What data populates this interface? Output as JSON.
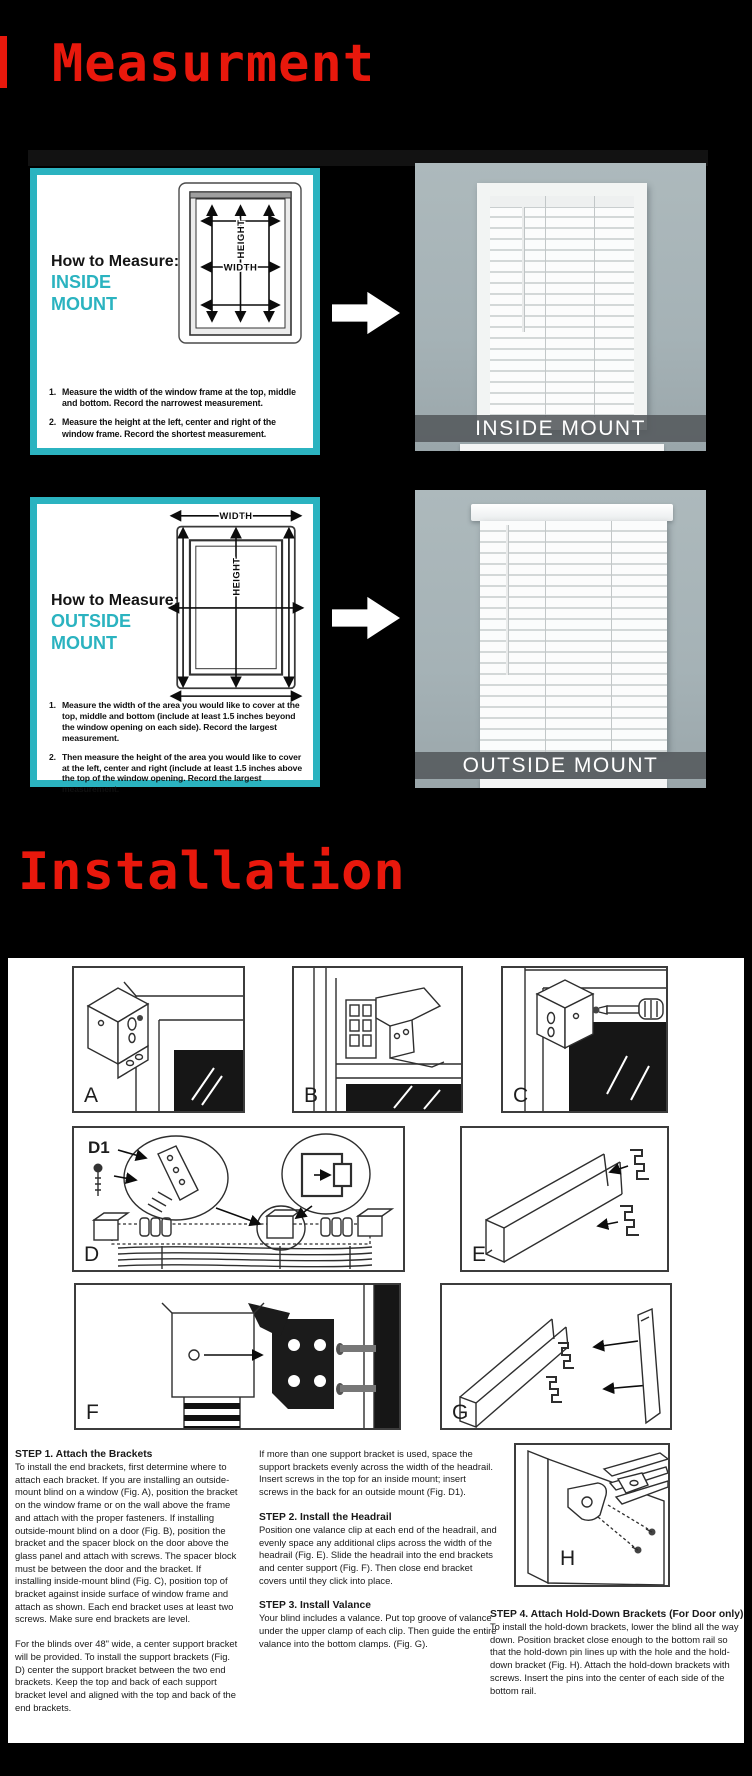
{
  "colors": {
    "accent_teal": "#2bb3c0",
    "title_red": "#e8180c",
    "photo_wall": "#a8b4b8",
    "caption_bar_gray": "#54595c"
  },
  "measurement_section": {
    "title": "Measurment",
    "inside": {
      "heading": "How to Measure:",
      "mount_label": "INSIDE MOUNT",
      "diagram": {
        "width_label": "WIDTH",
        "height_label": "HEIGHT"
      },
      "steps": [
        {
          "num": "1.",
          "text": "Measure the width of the window frame at the top, middle and bottom. Record the narrowest measurement."
        },
        {
          "num": "2.",
          "text": "Measure the height at the left, center and right of the window frame. Record the shortest measurement."
        }
      ],
      "photo_caption": "INSIDE MOUNT"
    },
    "outside": {
      "heading": "How to Measure:",
      "mount_label": "OUTSIDE MOUNT",
      "diagram": {
        "width_label": "WIDTH",
        "height_label": "HEIGHT"
      },
      "steps": [
        {
          "num": "1.",
          "text": "Measure the width of the area you would like to cover at the top, middle and bottom (include at least 1.5 inches beyond the window opening on each side). Record the largest measurement."
        },
        {
          "num": "2.",
          "text": "Then measure the height of the area you would like to cover at the left, center and right (include at least 1.5 inches above the top of the window opening. Record the largest measurement."
        }
      ],
      "photo_caption": "OUTSIDE MOUNT"
    }
  },
  "installation_section": {
    "title": "Installation",
    "figures": [
      "A",
      "B",
      "C",
      "D",
      "E",
      "F",
      "G",
      "H"
    ],
    "d1_label": "D1",
    "step1": {
      "heading": "STEP 1. Attach the Brackets",
      "body": "To install the end brackets, first determine where to attach each bracket.  If you are installing an outside-mount blind on a window (Fig. A), position the bracket on the window frame or on the wall above the frame and attach with the proper fasteners.  If installing outside-mount blind on a door (Fig. B), position the bracket and the spacer block on the door above the glass panel and attach with screws. The spacer block must be between the door and the bracket.  If installing inside-mount blind (Fig. C), position top of bracket against inside surface of window frame and attach as shown. Each end bracket uses at least two screws.  Make sure end brackets are level.",
      "body2": "For the blinds over 48\" wide, a center support bracket will be provided.   To install the support brackets (Fig. D) center the support bracket between the two end brackets. Keep the top and back of each support bracket level and aligned with the top and back of the end brackets."
    },
    "step1_cont": "If more than one support bracket is used, space the support brackets evenly across the width of the headrail. Insert screws in the top for an inside mount; insert screws in the back for an outside mount (Fig. D1).",
    "step2": {
      "heading": "STEP 2. Install the Headrail",
      "body": "Position one valance clip at each end of the headrail, and evenly space any additional clips across the width of the headrail (Fig. E). Slide the headrail into the end brackets and center support (Fig. F).   Then close end bracket covers until they click into place."
    },
    "step3": {
      "heading": "STEP 3. Install Valance",
      "body": "Your blind includes a valance. Put top groove of valance under the upper clamp of each clip. Then guide the entire valance into the bottom clamps. (Fig. G)."
    },
    "step4": {
      "heading": "STEP 4. Attach Hold-Down Brackets (For Door only)",
      "body": "To install the hold-down brackets, lower the blind all the way down. Position bracket close enough to the bottom rail so that the hold-down pin lines up with the hole and the hold-down bracket (Fig. H). Attach the hold-down brackets with screws.  Insert the pins into the center of each side of the bottom rail."
    }
  }
}
